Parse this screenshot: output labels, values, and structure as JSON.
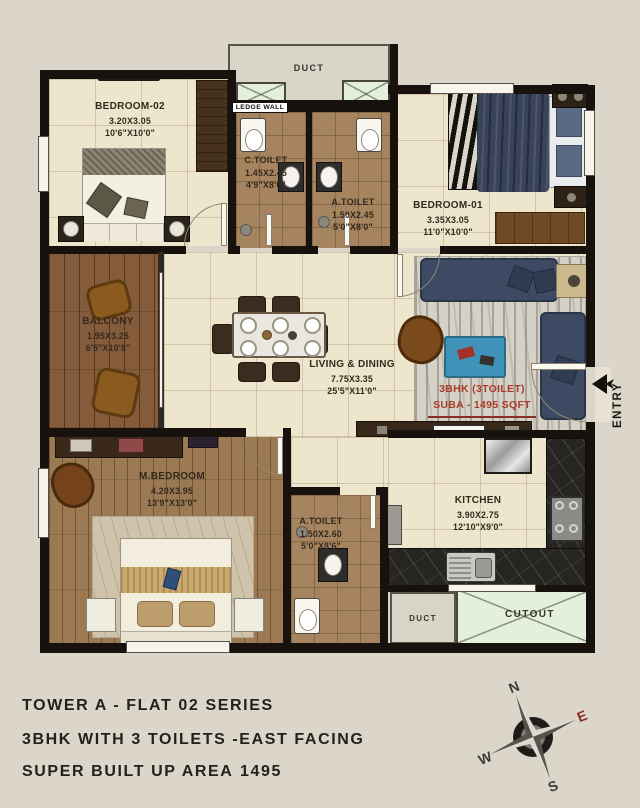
{
  "plan": {
    "rooms": [
      {
        "id": "bedroom-02",
        "name": "BEDROOM-02",
        "dim_m": "3.20X3.05",
        "dim_ft": "10'6\"X10'0\""
      },
      {
        "id": "c-toilet",
        "name": "C.TOILET",
        "dim_m": "1.45X2.45",
        "dim_ft": "4'9\"X8'0\""
      },
      {
        "id": "a-toilet-top",
        "name": "A.TOILET",
        "dim_m": "1.50X2.45",
        "dim_ft": "5'0\"X8'0\""
      },
      {
        "id": "bedroom-01",
        "name": "BEDROOM-01",
        "dim_m": "3.35X3.05",
        "dim_ft": "11'0\"X10'0\""
      },
      {
        "id": "balcony",
        "name": "BALCONY",
        "dim_m": "1.95X3.25",
        "dim_ft": "6'5\"X10'8\""
      },
      {
        "id": "living-dining",
        "name": "LIVING & DINING",
        "dim_m": "7.75X3.35",
        "dim_ft": "25'5\"X11'0\""
      },
      {
        "id": "m-bedroom",
        "name": "M.BEDROOM",
        "dim_m": "4.20X3.95",
        "dim_ft": "13'9\"X13'0\""
      },
      {
        "id": "a-toilet-bottom",
        "name": "A.TOILET",
        "dim_m": "1.50X2.60",
        "dim_ft": "5'0\"X8'6\""
      },
      {
        "id": "kitchen",
        "name": "KITCHEN",
        "dim_m": "3.90X2.75",
        "dim_ft": "12'10\"X9'0\""
      }
    ],
    "annotations": {
      "duct_top": "DUCT",
      "duct_bottom": "DUCT",
      "cutout": "CUTOUT",
      "ledge_wall": "LEDGE WALL",
      "entry": "ENTRY",
      "unit_line1": "3BHK (3TOILET)",
      "unit_line2": "SUBA - 1495 SQFT"
    }
  },
  "footer": {
    "line1": "TOWER A - FLAT 02 SERIES",
    "line2": "3BHK WITH 3 TOILETS -EAST FACING",
    "line3": "SUPER BUILT UP AREA",
    "area_value": "1495"
  },
  "compass": {
    "n": "N",
    "e": "E",
    "s": "S",
    "w": "W"
  },
  "colors": {
    "background": "#dbd6c9",
    "wall": "#17120e",
    "accent_red": "#a93b28",
    "floor_cream": "#eee5cd",
    "floor_toilet": "#a6845f",
    "wood": "#8a6040",
    "sofa_navy": "#3d4a63",
    "cutout_green": "#e4f0dc",
    "compass_east_red": "#8a2f20"
  }
}
